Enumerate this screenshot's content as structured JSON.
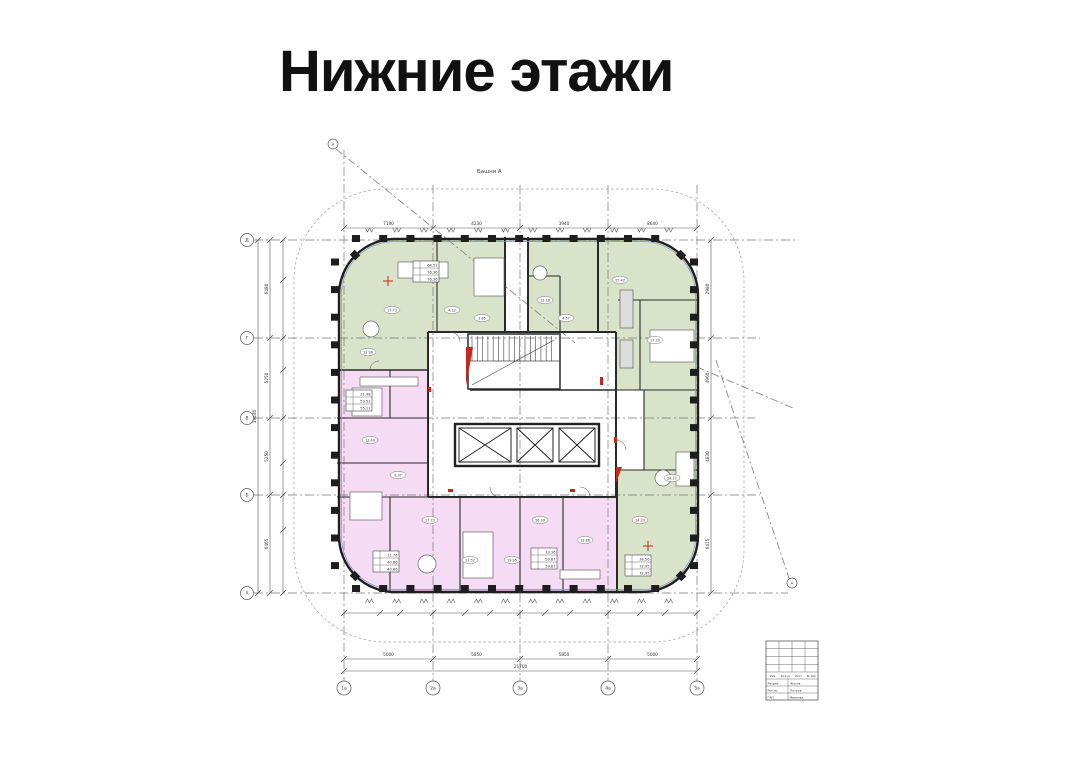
{
  "page": {
    "title": "Нижние этажи"
  },
  "plan": {
    "tower_label": "Башня А",
    "colors": {
      "green": "#d8e3c9",
      "pink": "#f6dbf4",
      "wall": "#222222",
      "red": "#c5271a",
      "line": "#6e6e6e"
    },
    "axes": {
      "left": [
        "Д",
        "Г",
        "В",
        "Б",
        "А"
      ],
      "bottom": [
        "1а",
        "2а",
        "3а",
        "4а",
        "5а"
      ],
      "corner_top": "А",
      "corner_right": "А"
    },
    "dims": {
      "top": [
        "7190",
        "4230",
        "3940",
        "8640"
      ],
      "left": [
        "6480",
        "5250",
        "5250",
        "6465"
      ],
      "left_total": "19440",
      "right": [
        "2980",
        "4960",
        "4830",
        "6415"
      ],
      "bottom": [
        "5000",
        "5850",
        "5850",
        "5000"
      ],
      "bottom_total": "21700"
    },
    "rooms": [
      "17.73",
      "12.96",
      "4.12",
      "3.85",
      "23.18",
      "4.57",
      "15.42",
      "17.20",
      "28.12",
      "14.29",
      "17.73",
      "11.52",
      "16.30",
      "13.86",
      "12.40",
      "9.37",
      "15.80",
      "19.95"
    ],
    "stats": [
      {
        "rows": [
          "64.51",
          "76.36",
          "76.36"
        ]
      },
      {
        "rows": [
          "21.48",
          "53.52",
          "55.11"
        ]
      },
      {
        "rows": [
          "11.76",
          "40.66",
          "40.66"
        ]
      },
      {
        "rows": [
          "13.36",
          "59.87",
          "59.87"
        ]
      },
      {
        "rows": [
          "38.56",
          "72.95",
          "72.95"
        ]
      }
    ],
    "stamp": {
      "header": [
        "Изм",
        "Кол.уч",
        "Лист",
        "№ док"
      ],
      "rows": [
        [
          "Разраб",
          "Жуков"
        ],
        [
          "Рук.гр.",
          "Петров"
        ],
        [
          "ГАП",
          "Иванова"
        ]
      ]
    }
  }
}
